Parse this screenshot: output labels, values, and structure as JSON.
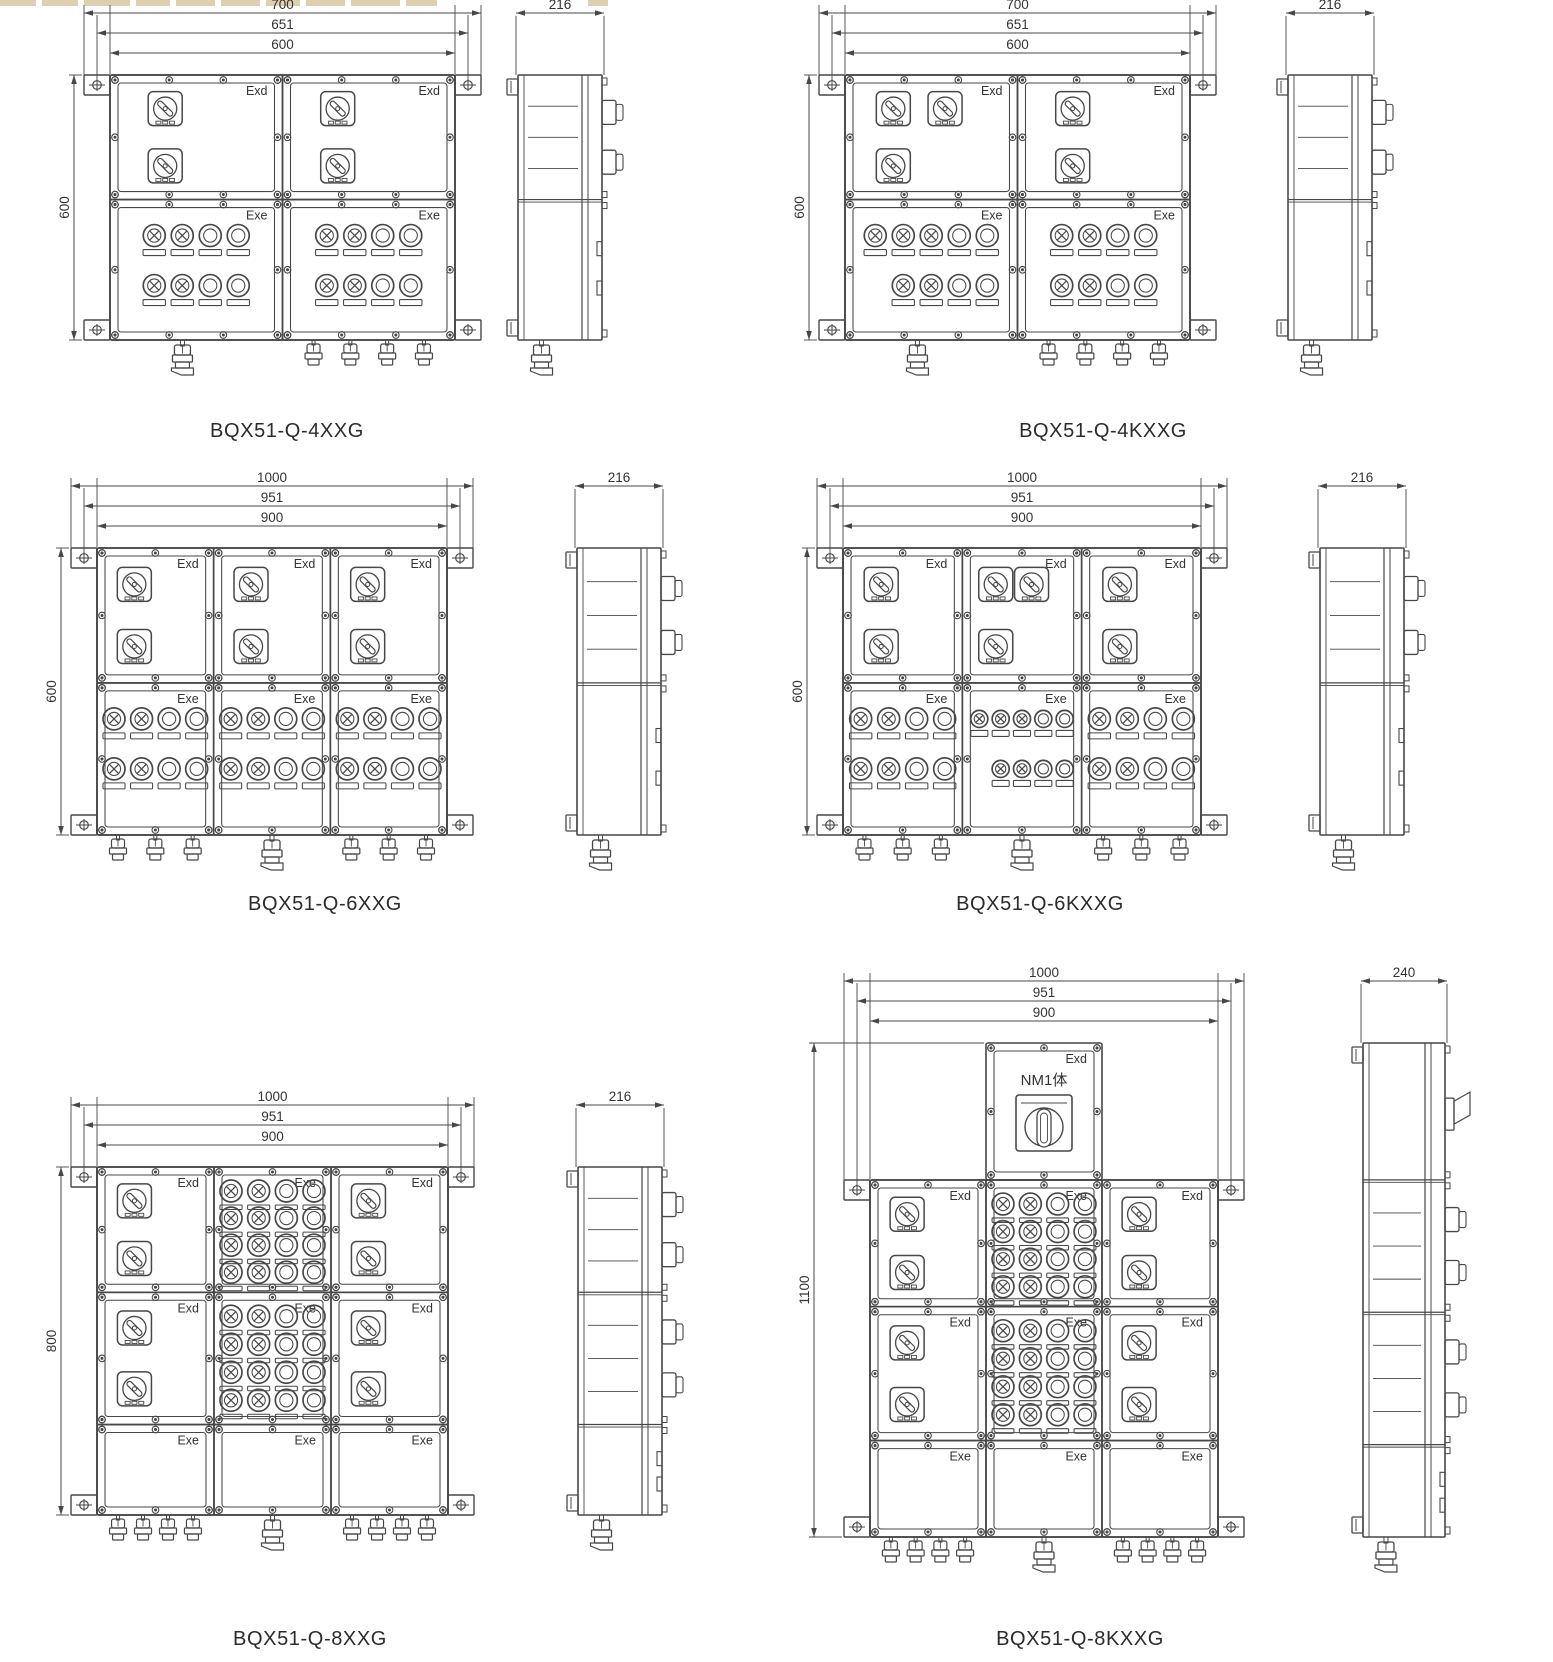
{
  "page": {
    "bg": "#ffffff",
    "line_color": "#474747",
    "text_color": "#333333"
  },
  "artifact": {
    "color": "#cdb584"
  },
  "labels": {
    "exd": "Exd",
    "exe": "Exe"
  },
  "diagrams": [
    {
      "id": "4xxg",
      "caption": "BQX51-Q-4XXG",
      "dims_top": [
        "700",
        "651",
        "600"
      ],
      "dim_left": "600",
      "side_dim": "216",
      "layout": {
        "fx": 110,
        "fy": 75,
        "fw": 345,
        "fh": 265,
        "sx": 518,
        "sw": 84,
        "cap_x": 287,
        "cap_y": 418
      },
      "rows": [
        {
          "hf": 0.47,
          "cells": [
            {
              "label": "Exd",
              "sw": "v2"
            },
            {
              "label": "Exd",
              "sw": "v2"
            }
          ]
        },
        {
          "hf": 0.53,
          "cells": [
            {
              "label": "Exe",
              "lamps": [
                {
                  "n": 4,
                  "c": 2
                },
                {
                  "n": 4,
                  "c": 2
                }
              ]
            },
            {
              "label": "Exe",
              "lamps": [
                {
                  "n": 4,
                  "c": 2
                },
                {
                  "n": 4,
                  "c": 2
                }
              ]
            }
          ]
        }
      ],
      "glands": [
        [
          "B"
        ],
        [
          "s",
          "s",
          "s",
          "s"
        ]
      ],
      "side_sections": [
        {
          "hf": 0.47,
          "prot": 2,
          "fins": 3
        },
        {
          "hf": 0.53,
          "prot": 0,
          "tabs": 2
        }
      ]
    },
    {
      "id": "4kxxg",
      "caption": "BQX51-Q-4KXXG",
      "dims_top": [
        "700",
        "651",
        "600"
      ],
      "dim_left": "600",
      "side_dim": "216",
      "layout": {
        "fx": 845,
        "fy": 75,
        "fw": 345,
        "fh": 265,
        "sx": 1288,
        "sw": 84,
        "cap_x": 1103,
        "cap_y": 418
      },
      "rows": [
        {
          "hf": 0.47,
          "cells": [
            {
              "label": "Exd",
              "sw": "h2v1"
            },
            {
              "label": "Exd",
              "sw": "v2"
            }
          ]
        },
        {
          "hf": 0.53,
          "cells": [
            {
              "label": "Exe",
              "lamps": [
                {
                  "n": 5,
                  "c": 3
                },
                {
                  "n": 4,
                  "c": 2,
                  "off": 0.5
                }
              ]
            },
            {
              "label": "Exe",
              "lamps": [
                {
                  "n": 4,
                  "c": 2
                },
                {
                  "n": 4,
                  "c": 2
                }
              ]
            }
          ]
        }
      ],
      "glands": [
        [
          "B"
        ],
        [
          "s",
          "s",
          "s",
          "s"
        ]
      ],
      "side_sections": [
        {
          "hf": 0.47,
          "prot": 2,
          "fins": 3
        },
        {
          "hf": 0.53,
          "prot": 0,
          "tabs": 2
        }
      ]
    },
    {
      "id": "6xxg",
      "caption": "BQX51-Q-6XXG",
      "dims_top": [
        "1000",
        "951",
        "900"
      ],
      "dim_left": "600",
      "side_dim": "216",
      "layout": {
        "fx": 97,
        "fy": 548,
        "fw": 350,
        "fh": 287,
        "sx": 577,
        "sw": 84,
        "cap_x": 325,
        "cap_y": 893
      },
      "rows": [
        {
          "hf": 0.47,
          "cells": [
            {
              "label": "Exd",
              "sw": "v2"
            },
            {
              "label": "Exd",
              "sw": "v2"
            },
            {
              "label": "Exd",
              "sw": "v2"
            }
          ]
        },
        {
          "hf": 0.53,
          "cells": [
            {
              "label": "Exe",
              "lamps": [
                {
                  "n": 4,
                  "c": 2
                },
                {
                  "n": 4,
                  "c": 2
                }
              ]
            },
            {
              "label": "Exe",
              "lamps": [
                {
                  "n": 4,
                  "c": 2
                },
                {
                  "n": 4,
                  "c": 2
                }
              ]
            },
            {
              "label": "Exe",
              "lamps": [
                {
                  "n": 4,
                  "c": 2
                },
                {
                  "n": 4,
                  "c": 2
                }
              ]
            }
          ]
        }
      ],
      "glands": [
        [
          "s",
          "s",
          "s"
        ],
        [
          "B"
        ],
        [
          "s",
          "s",
          "s"
        ]
      ],
      "side_sections": [
        {
          "hf": 0.47,
          "prot": 2,
          "fins": 3
        },
        {
          "hf": 0.53,
          "prot": 0,
          "tabs": 2
        }
      ]
    },
    {
      "id": "6kxxg",
      "caption": "BQX51-Q-6KXXG",
      "dims_top": [
        "1000",
        "951",
        "900"
      ],
      "dim_left": "600",
      "side_dim": "216",
      "layout": {
        "fx": 843,
        "fy": 548,
        "fw": 358,
        "fh": 287,
        "sx": 1320,
        "sw": 84,
        "cap_x": 1040,
        "cap_y": 893
      },
      "rows": [
        {
          "hf": 0.47,
          "cells": [
            {
              "label": "Exd",
              "sw": "v2"
            },
            {
              "label": "Exd",
              "sw": "h2v1"
            },
            {
              "label": "Exd",
              "sw": "v2"
            }
          ]
        },
        {
          "hf": 0.53,
          "cells": [
            {
              "label": "Exe",
              "lamps": [
                {
                  "n": 4,
                  "c": 2
                },
                {
                  "n": 4,
                  "c": 2
                }
              ]
            },
            {
              "label": "Exe",
              "lamps": [
                {
                  "n": 5,
                  "c": 3
                },
                {
                  "n": 4,
                  "c": 2,
                  "off": 0.5
                }
              ]
            },
            {
              "label": "Exe",
              "lamps": [
                {
                  "n": 4,
                  "c": 2
                },
                {
                  "n": 4,
                  "c": 2
                }
              ]
            }
          ]
        }
      ],
      "glands": [
        [
          "s",
          "s",
          "s"
        ],
        [
          "B"
        ],
        [
          "s",
          "s",
          "s"
        ]
      ],
      "side_sections": [
        {
          "hf": 0.47,
          "prot": 2,
          "fins": 3
        },
        {
          "hf": 0.53,
          "prot": 0,
          "tabs": 2
        }
      ]
    },
    {
      "id": "8xxg",
      "caption": "BQX51-Q-8XXG",
      "dims_top": [
        "1000",
        "951",
        "900"
      ],
      "dim_left": "800",
      "side_dim": "216",
      "layout": {
        "fx": 97,
        "fy": 1167,
        "fw": 351,
        "fh": 348,
        "sx": 578,
        "sw": 84,
        "cap_x": 310,
        "cap_y": 1628
      },
      "rows": [
        {
          "hf": 0.36,
          "cells": [
            {
              "label": "Exd",
              "sw": "v2"
            },
            {
              "label": "Exe",
              "lamps": [
                {
                  "n": 4,
                  "c": 2
                },
                {
                  "n": 4,
                  "c": 2
                },
                {
                  "n": 4,
                  "c": 2
                },
                {
                  "n": 4,
                  "c": 2
                }
              ]
            },
            {
              "label": "Exd",
              "sw": "v2"
            }
          ]
        },
        {
          "hf": 0.38,
          "cells": [
            {
              "label": "Exd",
              "sw": "v2"
            },
            {
              "label": "Exe",
              "lamps": [
                {
                  "n": 4,
                  "c": 2
                },
                {
                  "n": 4,
                  "c": 2
                },
                {
                  "n": 4,
                  "c": 2
                },
                {
                  "n": 4,
                  "c": 2
                }
              ]
            },
            {
              "label": "Exd",
              "sw": "v2"
            }
          ]
        },
        {
          "hf": 0.26,
          "cells": [
            {
              "label": "Exe"
            },
            {
              "label": "Exe"
            },
            {
              "label": "Exe"
            }
          ]
        }
      ],
      "glands": [
        [
          "s",
          "s",
          "s",
          "s"
        ],
        [
          "B"
        ],
        [
          "s",
          "s",
          "s",
          "s"
        ]
      ],
      "side_sections": [
        {
          "hf": 0.36,
          "prot": 2,
          "fins": 3
        },
        {
          "hf": 0.38,
          "prot": 2,
          "fins": 3
        },
        {
          "hf": 0.26,
          "prot": 0,
          "tabs": 2
        }
      ]
    },
    {
      "id": "8kxxg",
      "caption": "BQX51-Q-8KXXG",
      "dims_top": [
        "1000",
        "951",
        "900"
      ],
      "dim_left": "1100",
      "side_dim": "240",
      "layout": {
        "fx": 870,
        "fy": 1180,
        "fw": 348,
        "fh": 357,
        "sx": 1363,
        "sw": 82,
        "sy": 1043,
        "sh": 494,
        "cap_x": 1080,
        "cap_y": 1628
      },
      "top_box": {
        "h": 137,
        "label": "Exd",
        "device_label": "NM1体"
      },
      "rows": [
        {
          "hf": 0.355,
          "cells": [
            {
              "label": "Exd",
              "sw": "v2"
            },
            {
              "label": "Exe",
              "lamps": [
                {
                  "n": 4,
                  "c": 2
                },
                {
                  "n": 4,
                  "c": 2
                },
                {
                  "n": 4,
                  "c": 2
                },
                {
                  "n": 4,
                  "c": 2
                }
              ]
            },
            {
              "label": "Exd",
              "sw": "v2"
            }
          ]
        },
        {
          "hf": 0.375,
          "cells": [
            {
              "label": "Exd",
              "sw": "v2"
            },
            {
              "label": "Exe",
              "lamps": [
                {
                  "n": 4,
                  "c": 2
                },
                {
                  "n": 4,
                  "c": 2
                },
                {
                  "n": 4,
                  "c": 2
                },
                {
                  "n": 4,
                  "c": 2
                }
              ]
            },
            {
              "label": "Exd",
              "sw": "v2"
            }
          ]
        },
        {
          "hf": 0.27,
          "cells": [
            {
              "label": "Exe"
            },
            {
              "label": "Exe"
            },
            {
              "label": "Exe"
            }
          ]
        }
      ],
      "glands": [
        [
          "s",
          "s",
          "s",
          "s"
        ],
        [
          "B"
        ],
        [
          "s",
          "s",
          "s",
          "s"
        ]
      ],
      "side_sections": [
        {
          "hf": 0.277,
          "prot": 1,
          "big": true
        },
        {
          "hf": 0.268,
          "prot": 2,
          "fins": 3
        },
        {
          "hf": 0.268,
          "prot": 2,
          "fins": 3
        },
        {
          "hf": 0.187,
          "prot": 0,
          "tabs": 2
        }
      ]
    }
  ]
}
